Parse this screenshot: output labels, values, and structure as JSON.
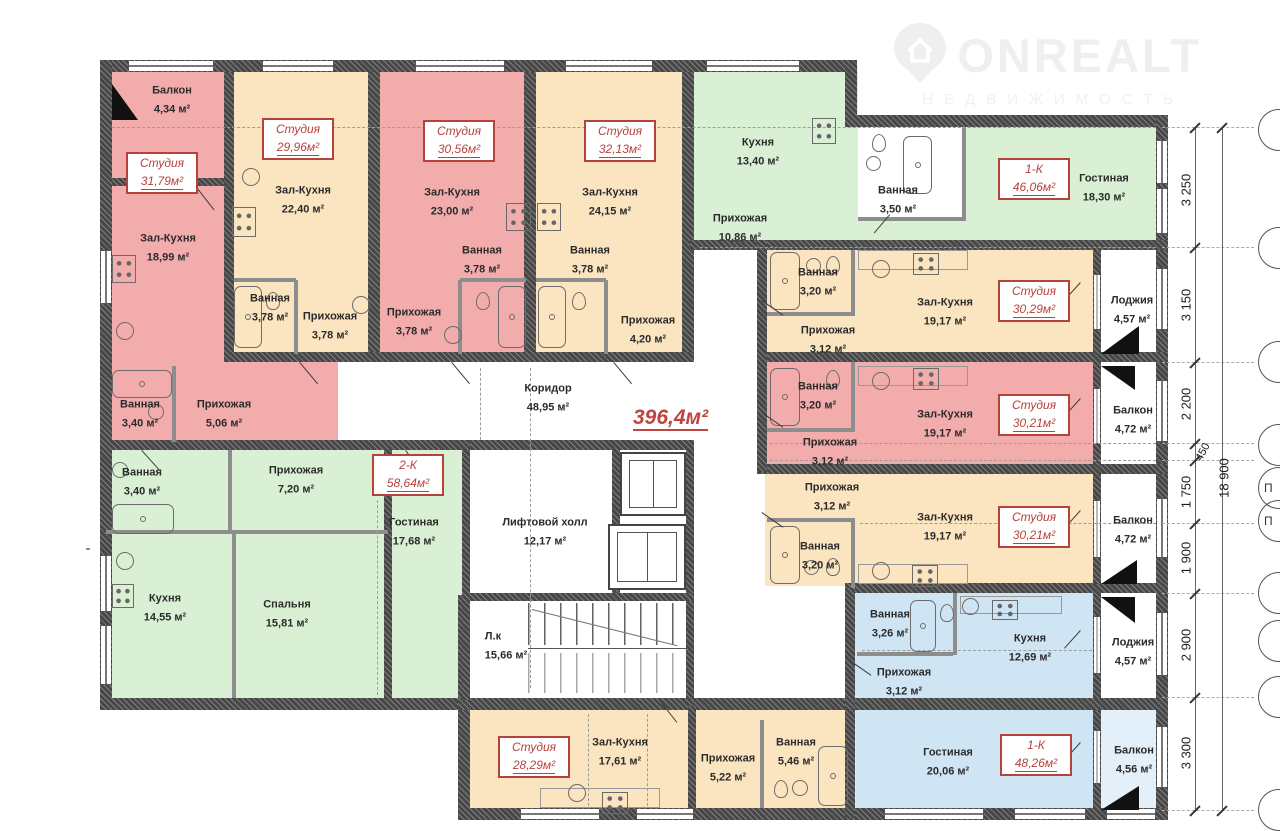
{
  "logo": {
    "brand": "ONREALT",
    "subtitle": "НЕДВИЖИМОСТЬ"
  },
  "total_area": "396,4м²",
  "units": {
    "u1": {
      "type": "Студия",
      "area": "31,79м²"
    },
    "u2": {
      "type": "Студия",
      "area": "29,96м²"
    },
    "u3": {
      "type": "Студия",
      "area": "30,56м²"
    },
    "u4": {
      "type": "Студия",
      "area": "32,13м²"
    },
    "u5": {
      "type": "1-К",
      "area": "46,06м²"
    },
    "u6": {
      "type": "Студия",
      "area": "30,29м²"
    },
    "u7": {
      "type": "Студия",
      "area": "30,21м²"
    },
    "u8": {
      "type": "Студия",
      "area": "30,21м²"
    },
    "u9": {
      "type": "2-К",
      "area": "58,64м²"
    },
    "u10": {
      "type": "Студия",
      "area": "28,29м²"
    },
    "u11": {
      "type": "1-К",
      "area": "48,26м²"
    }
  },
  "rooms": {
    "u1_balcony": {
      "name": "Балкон",
      "area": "4,34 м²"
    },
    "u1_hall": {
      "name": "Зал-Кухня",
      "area": "18,99 м²"
    },
    "u1_bath": {
      "name": "Ванная",
      "area": "3,40 м²"
    },
    "u1_entry": {
      "name": "Прихожая",
      "area": "5,06 м²"
    },
    "u2_hall": {
      "name": "Зал-Кухня",
      "area": "22,40 м²"
    },
    "u2_bath": {
      "name": "Ванная",
      "area": "3,78 м²"
    },
    "u2_entry": {
      "name": "Прихожая",
      "area": "3,78 м²"
    },
    "u3_hall": {
      "name": "Зал-Кухня",
      "area": "23,00 м²"
    },
    "u3_entry": {
      "name": "Прихожая",
      "area": "3,78 м²"
    },
    "u3_bath": {
      "name": "Ванная",
      "area": "3,78 м²"
    },
    "u4_hall": {
      "name": "Зал-Кухня",
      "area": "24,15 м²"
    },
    "u4_bath": {
      "name": "Ванная",
      "area": "3,78 м²"
    },
    "u4_entry": {
      "name": "Прихожая",
      "area": "4,20 м²"
    },
    "u5_kitchen": {
      "name": "Кухня",
      "area": "13,40 м²"
    },
    "u5_entry": {
      "name": "Прихожая",
      "area": "10,86 м²"
    },
    "u5_bath": {
      "name": "Ванная",
      "area": "3,50 м²"
    },
    "u5_living": {
      "name": "Гостиная",
      "area": "18,30 м²"
    },
    "u6_bath": {
      "name": "Ванная",
      "area": "3,20 м²"
    },
    "u6_entry": {
      "name": "Прихожая",
      "area": "3,12 м²"
    },
    "u6_hall": {
      "name": "Зал-Кухня",
      "area": "19,17 м²"
    },
    "u6_loggia": {
      "name": "Лоджия",
      "area": "4,57 м²"
    },
    "u7_bath": {
      "name": "Ванная",
      "area": "3,20 м²"
    },
    "u7_entry": {
      "name": "Прихожая",
      "area": "3,12 м²"
    },
    "u7_hall": {
      "name": "Зал-Кухня",
      "area": "19,17 м²"
    },
    "u7_balcony": {
      "name": "Балкон",
      "area": "4,72 м²"
    },
    "u8_entry": {
      "name": "Прихожая",
      "area": "3,12 м²"
    },
    "u8_bath": {
      "name": "Ванная",
      "area": "3,20 м²"
    },
    "u8_hall": {
      "name": "Зал-Кухня",
      "area": "19,17 м²"
    },
    "u8_balcony": {
      "name": "Балкон",
      "area": "4,72 м²"
    },
    "u9_bath": {
      "name": "Ванная",
      "area": "3,40 м²"
    },
    "u9_entry": {
      "name": "Прихожая",
      "area": "7,20 м²"
    },
    "u9_kitchen": {
      "name": "Кухня",
      "area": "14,55 м²"
    },
    "u9_bedroom": {
      "name": "Спальня",
      "area": "15,81 м²"
    },
    "u9_living": {
      "name": "Гостиная",
      "area": "17,68 м²"
    },
    "u10_hall": {
      "name": "Зал-Кухня",
      "area": "17,61 м²"
    },
    "u10_entry": {
      "name": "Прихожая",
      "area": "5,22 м²"
    },
    "u10_bath": {
      "name": "Ванная",
      "area": "5,46 м²"
    },
    "u11_bath": {
      "name": "Ванная",
      "area": "3,26 м²"
    },
    "u11_entry": {
      "name": "Прихожая",
      "area": "3,12 м²"
    },
    "u11_kitchen": {
      "name": "Кухня",
      "area": "12,69 м²"
    },
    "u11_loggia": {
      "name": "Лоджия",
      "area": "4,57 м²"
    },
    "u11_living": {
      "name": "Гостиная",
      "area": "20,06 м²"
    },
    "u11_balcony": {
      "name": "Балкон",
      "area": "4,56 м²"
    },
    "corridor": {
      "name": "Коридор",
      "area": "48,95 м²"
    },
    "lift_hall": {
      "name": "Лифтовой холл",
      "area": "12,17 м²"
    },
    "stairs": {
      "name": "Л.к",
      "area": "15,66 м²"
    }
  },
  "dimensions": {
    "segments": [
      "3 250",
      "3 150",
      "2 200",
      "1 750",
      "1 900",
      "2 900",
      "3 300"
    ],
    "small": "450",
    "total": "18 900",
    "axis_letter": "П"
  },
  "colors": {
    "pink": "#f3acac",
    "beige": "#fbe4c0",
    "green": "#d9f0d5",
    "blue": "#cfe5f4",
    "wall": "#474747",
    "accent_red": "#b6423c"
  }
}
